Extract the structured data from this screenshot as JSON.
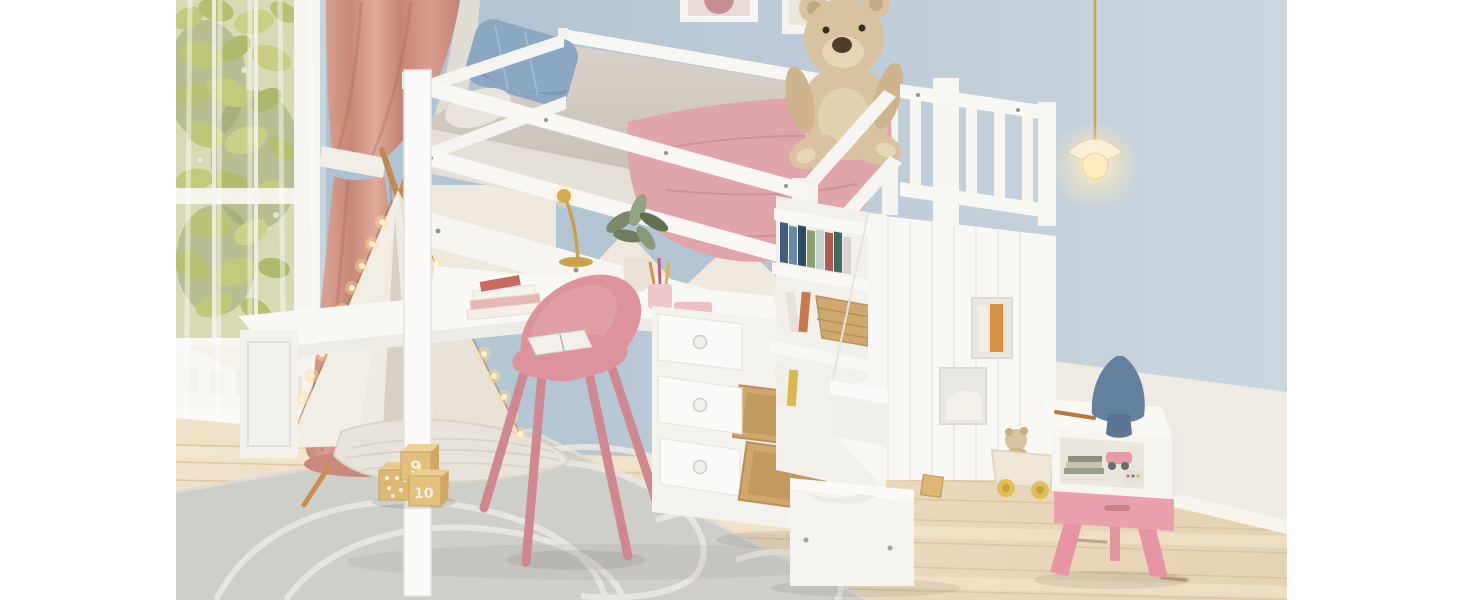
{
  "scene": {
    "type": "product-photo",
    "setting": "kids bedroom",
    "subject": "White loft bed with desk, drawers, bookshelf and storage staircase"
  },
  "colors": {
    "wall_blue": "#b7c9d5",
    "wainscot_cream": "#f0ebe2",
    "window_frame": "#f4f1ea",
    "leaves_green": "#a9b241",
    "curtain_pink": "#cd9184",
    "teepee_canvas": "#f2eee6",
    "fairy_light": "#ffe9b8",
    "floor_wood": "#ecdcc1",
    "rug_gray": "#cfcfc9",
    "rug_line": "#e9e8e2",
    "furniture_white": "#f8f7f4",
    "mattress_gray": "#cfc8bf",
    "blanket_pink": "#dfa5aa",
    "pillow_blue": "#8ca7c2",
    "teddy_tan": "#d9c29f",
    "chair_pink": "#dd939b",
    "nightstand_pink": "#e9a2ad",
    "mushroom_blue": "#64809f",
    "pendant_glow": "#ffedc2",
    "drawer_wood": "#d0a76c",
    "block_wood": "#e0be7c",
    "art_rose": "#c88e96"
  },
  "toys": {
    "block_labels": [
      "9",
      "10"
    ]
  }
}
